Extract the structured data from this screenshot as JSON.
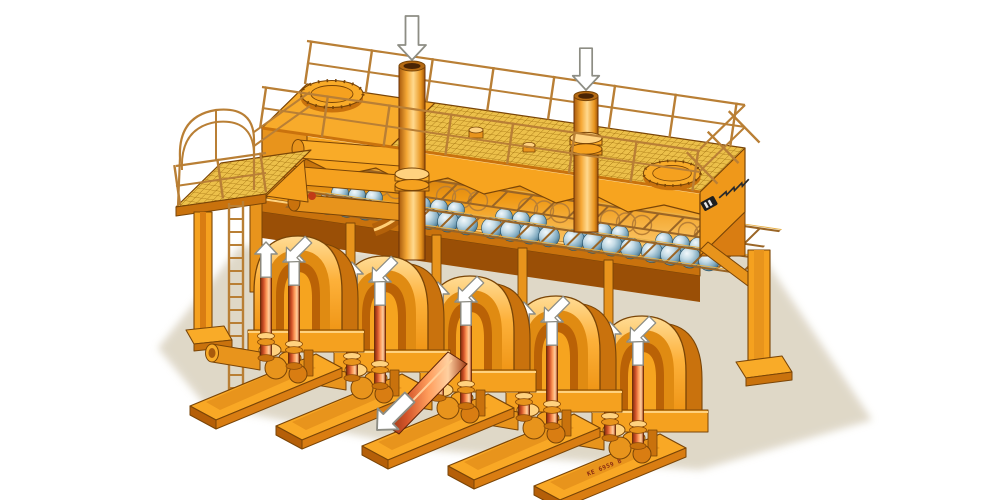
{
  "illustration": {
    "subject": "Isometric cutaway technical illustration of a five-cylinder piston pump station with ball-valve chambers, overhead air vessel, mesh walkway deck, guard railings and access platform",
    "background": "white",
    "brand_inscription": "(small illegible italic brand inscription with dark striped logo badge on right end panel)",
    "serial_marking": "KE 6959 B",
    "counts": {
      "pump_units": 5,
      "inlet_pipes": 2,
      "manhole_covers": 2,
      "ball_valve_groups": 5,
      "access_platforms": 1
    },
    "arrows": {
      "inlet_down_arrows": 2,
      "riser_up_arrows": 10,
      "pump_face_arrows": 5,
      "discharge_outline_arrows": 1
    }
  },
  "palette": {
    "bg": "#ffffff",
    "groundShadow": "#dcd4c2",
    "orangeMain": "#f5a11f",
    "orangeLight": "#ffc95e",
    "orangeLighter": "#ffe3a3",
    "orangeDark": "#d97d12",
    "orangeDeep": "#b05c07",
    "outline": "#7a4507",
    "meshFill": "#ecc04a",
    "meshLine": "#a87714",
    "railing": "#b97f35",
    "copperDark": "#8a2f10",
    "copperMid": "#e06030",
    "copperLight": "#ffb46a",
    "ballLight": "#eaf4f9",
    "ballMid": "#9cc2d4",
    "ballDark": "#3f7491",
    "arrowFill": "#ffffff",
    "arrowStroke": "#8d8d84",
    "serialColor": "#8a2c12"
  }
}
